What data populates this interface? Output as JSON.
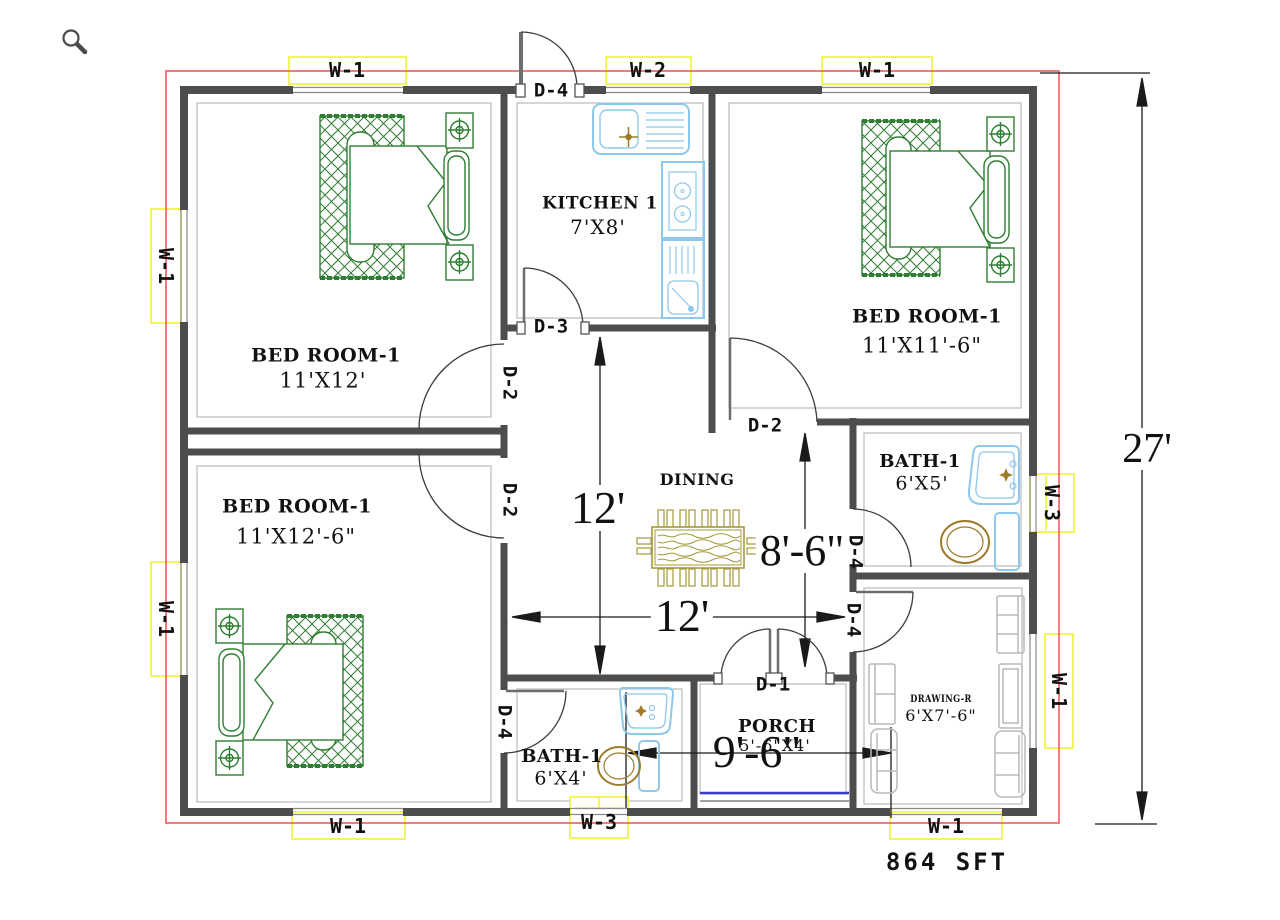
{
  "plan": {
    "area_label": "864 SFT",
    "rooms": [
      {
        "name": "BED ROOM-1",
        "dims": "11'X12'"
      },
      {
        "name": "BED ROOM-1",
        "dims": "11'X11'-6\""
      },
      {
        "name": "BED ROOM-1",
        "dims": "11'X12'-6\""
      },
      {
        "name": "KITCHEN 1",
        "dims": "7'X8'"
      },
      {
        "name": "DINING"
      },
      {
        "name": "BATH-1",
        "dims": "6'X5'"
      },
      {
        "name": "BATH-1",
        "dims": "6'X4'"
      },
      {
        "name": "PORCH",
        "dims": "5'-6\"X4'"
      },
      {
        "name": "DRAWING-R",
        "dims": "6'X7'-6\""
      }
    ],
    "windows": {
      "top_left": "W-1",
      "top_mid": "W-2",
      "top_right": "W-1",
      "left_upper": "W-1",
      "left_lower": "W-1",
      "right_upper": "W-3",
      "right_lower": "W-1",
      "bottom_left": "W-1",
      "bottom_mid": "W-3",
      "bottom_right": "W-1"
    },
    "doors": {
      "entry": "D-4",
      "kitchen": "D-3",
      "bed_tl": "D-2",
      "bed_bl": "D-2",
      "bed_tr": "D-2",
      "bath_tr": "D-4",
      "drawing": "D-4",
      "porch": "D-1",
      "bath_b": "D-4"
    },
    "dims": {
      "overall": "27'",
      "dining_v": "12'",
      "dining_h": "12'",
      "right_v": "8'-6\"",
      "bottom_h": "9'-6\""
    }
  },
  "icons": {
    "zoom": "magnifier"
  },
  "colors": {
    "wall": "#4d4d4d",
    "boundary_line": "#f05a5a",
    "window_frame": "#f2f235",
    "bed_green": "#2f7d32",
    "fixture_blue": "#8ec8ec",
    "wood_olive": "#a39a3a",
    "sofa_gray": "#b8b8b8",
    "porch_blue": "#3a3ac8"
  }
}
